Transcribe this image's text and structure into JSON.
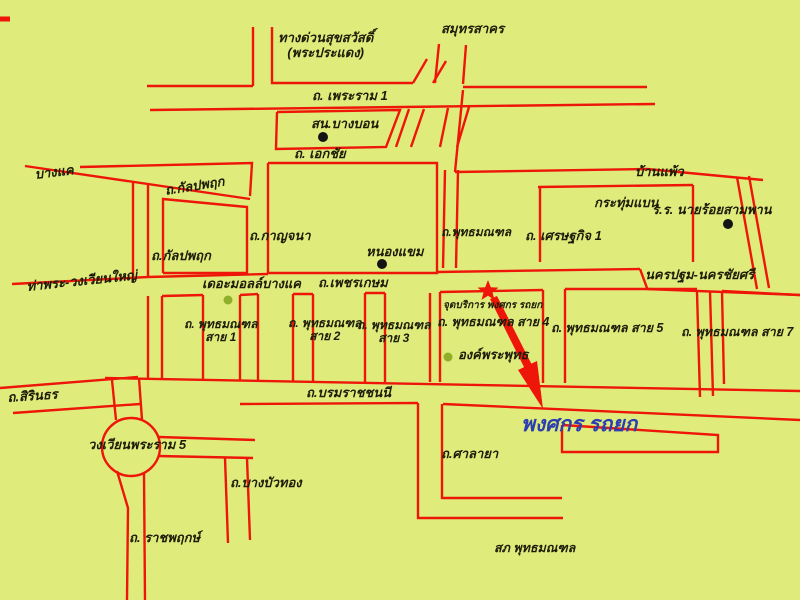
{
  "map": {
    "width": 800,
    "height": 600,
    "colors": {
      "background": "#dfec7c",
      "road": "#ee1509",
      "text": "#1c1c08",
      "highlight_blue": "#2a3eb1",
      "dot_black": "#141414",
      "dot_green": "#8fae29"
    },
    "labels": [
      {
        "id": "expressway-suksawat",
        "text": "ทางด่วนสุขสวัสดิ์\n(พระประแดง)",
        "x": 278,
        "y": 31,
        "size": 13
      },
      {
        "id": "samut-sakhon",
        "text": "สมุทรสาคร",
        "x": 441,
        "y": 22,
        "size": 13
      },
      {
        "id": "rama1-road",
        "text": "ถ. เพระราม 1",
        "x": 312,
        "y": 89,
        "size": 13
      },
      {
        "id": "bang-bon-police",
        "text": "สน.บางบอน",
        "x": 311,
        "y": 117,
        "size": 13
      },
      {
        "id": "ekkachai-road",
        "text": "ถ. เอกชัย",
        "x": 294,
        "y": 147,
        "size": 13
      },
      {
        "id": "bang-khae",
        "text": "บางแค",
        "x": 34,
        "y": 168,
        "size": 13,
        "rot": -7
      },
      {
        "id": "kanlapaphruek-road-upper",
        "text": "ถ.กัลปพฤก",
        "x": 164,
        "y": 184,
        "size": 13,
        "rot": -9
      },
      {
        "id": "kanlapaphruek-road-lower",
        "text": "ถ.กัลปพฤก",
        "x": 151,
        "y": 249,
        "size": 13
      },
      {
        "id": "kanchana-road",
        "text": "ถ.กาญจนา",
        "x": 249,
        "y": 229,
        "size": 13
      },
      {
        "id": "nong-khaem",
        "text": "หนองแขม",
        "x": 366,
        "y": 245,
        "size": 13
      },
      {
        "id": "phutthamonthon-road",
        "text": "ถ.พุทธมณฑล",
        "x": 441,
        "y": 226,
        "size": 12
      },
      {
        "id": "setthakit1-road",
        "text": "ถ. เศรษฐกิจ 1",
        "x": 525,
        "y": 229,
        "size": 13
      },
      {
        "id": "ban-phaeo",
        "text": "บ้านแพ้ว",
        "x": 635,
        "y": 165,
        "size": 13
      },
      {
        "id": "krathum-baen",
        "text": "กระทุ่มแบน",
        "x": 594,
        "y": 196,
        "size": 13
      },
      {
        "id": "military-academy",
        "text": "ร.ร. นายร้อยสามพาน",
        "x": 652,
        "y": 203,
        "size": 13
      },
      {
        "id": "tha-phra-wongwian-yai",
        "text": "ท่าพระ-วงเวียนใหญ่",
        "x": 26,
        "y": 280,
        "size": 13,
        "rot": -6
      },
      {
        "id": "the-mall-bang-khae",
        "text": "เดอะมอลล์บางแค",
        "x": 202,
        "y": 277,
        "size": 13
      },
      {
        "id": "phetkasem-road",
        "text": "ถ.เพชรเกษม",
        "x": 318,
        "y": 276,
        "size": 13
      },
      {
        "id": "nakhon-pathom-nakhon-chaisi",
        "text": "นครปฐม-นครชัยศรี",
        "x": 645,
        "y": 268,
        "size": 13
      },
      {
        "id": "service-point",
        "text": "จุดบริการ พงศกร รถยก",
        "x": 443,
        "y": 300,
        "size": 10
      },
      {
        "id": "phutthamonthon-sai1",
        "text": "ถ. พุทธมณฑล\nสาย 1",
        "x": 184,
        "y": 318,
        "size": 12
      },
      {
        "id": "phutthamonthon-sai2",
        "text": "ถ. พุทธมณฑล\nสาย 2",
        "x": 288,
        "y": 317,
        "size": 12
      },
      {
        "id": "phutthamonthon-sai3",
        "text": "ถ. พุทธมณฑล\nสาย 3",
        "x": 357,
        "y": 319,
        "size": 12
      },
      {
        "id": "phutthamonthon-sai4",
        "text": "ถ. พุทธมณฑล สาย 4",
        "x": 437,
        "y": 315,
        "size": 12.5
      },
      {
        "id": "phutthamonthon-sai5",
        "text": "ถ. พุทธมณฑล สาย 5",
        "x": 551,
        "y": 321,
        "size": 12.5
      },
      {
        "id": "phutthamonthon-sai7",
        "text": "ถ. พุทธมณฑล สาย 7",
        "x": 681,
        "y": 325,
        "size": 12.5
      },
      {
        "id": "buddha-monument",
        "text": "องค์พระพุทธ",
        "x": 458,
        "y": 348,
        "size": 13
      },
      {
        "id": "sirinthon-road",
        "text": "ถ.สิรินธร",
        "x": 7,
        "y": 391,
        "size": 13,
        "rot": -4
      },
      {
        "id": "borommaratchachonnani-road",
        "text": "ถ.บรมราชชนนี",
        "x": 306,
        "y": 386,
        "size": 13
      },
      {
        "id": "pongsakorn-towing",
        "text": "พงศกร รถยก",
        "x": 521,
        "y": 413,
        "size": 21,
        "color": "#2a3eb1"
      },
      {
        "id": "wongwian-rama5",
        "text": "วงเวียนพระราม 5",
        "x": 88,
        "y": 438,
        "size": 13
      },
      {
        "id": "salaya-road",
        "text": "ถ.ศาลายา",
        "x": 441,
        "y": 447,
        "size": 13
      },
      {
        "id": "bang-bua-thong-road",
        "text": "ถ.บางบัวทอง",
        "x": 230,
        "y": 476,
        "size": 13
      },
      {
        "id": "ratchaphruek-road",
        "text": "ถ. ราชพฤกษ์",
        "x": 129,
        "y": 531,
        "size": 13
      },
      {
        "id": "phutthamonthon-police",
        "text": "สภ พุทธมณฑล",
        "x": 494,
        "y": 541,
        "size": 12.5
      }
    ],
    "roads": [
      {
        "p": [
          [
            0,
            19
          ],
          [
            10,
            19
          ]
        ],
        "w": 5
      },
      {
        "p": [
          [
            253,
            27
          ],
          [
            253,
            86
          ]
        ]
      },
      {
        "p": [
          [
            272,
            27
          ],
          [
            272,
            83
          ],
          [
            413,
            83
          ]
        ]
      },
      {
        "p": [
          [
            147,
            86
          ],
          [
            253,
            86
          ]
        ]
      },
      {
        "p": [
          [
            413,
            83
          ],
          [
            427,
            59
          ]
        ]
      },
      {
        "p": [
          [
            433,
            83
          ],
          [
            446,
            61
          ]
        ]
      },
      {
        "p": [
          [
            439,
            44
          ],
          [
            435,
            83
          ]
        ]
      },
      {
        "p": [
          [
            466,
            45
          ],
          [
            463,
            84
          ]
        ]
      },
      {
        "p": [
          [
            463,
            87
          ],
          [
            647,
            87
          ]
        ]
      },
      {
        "p": [
          [
            150,
            110
          ],
          [
            655,
            104
          ]
        ]
      },
      {
        "p": [
          [
            277,
            112
          ],
          [
            400,
            110
          ],
          [
            386,
            147
          ],
          [
            276,
            149
          ],
          [
            277,
            112
          ]
        ]
      },
      {
        "p": [
          [
            409,
            109
          ],
          [
            396,
            147
          ]
        ]
      },
      {
        "p": [
          [
            424,
            109
          ],
          [
            411,
            147
          ]
        ]
      },
      {
        "p": [
          [
            448,
            108
          ],
          [
            440,
            147
          ]
        ]
      },
      {
        "p": [
          [
            469,
            107
          ],
          [
            457,
            147
          ]
        ]
      },
      {
        "p": [
          [
            463,
            90
          ],
          [
            455,
            172
          ]
        ]
      },
      {
        "p": [
          [
            455,
            172
          ],
          [
            647,
            169
          ],
          [
            763,
            180
          ]
        ]
      },
      {
        "p": [
          [
            737,
            177
          ],
          [
            757,
            289
          ]
        ]
      },
      {
        "p": [
          [
            749,
            176
          ],
          [
            769,
            288
          ]
        ]
      },
      {
        "p": [
          [
            80,
            167
          ],
          [
            252,
            163
          ],
          [
            250,
            196
          ]
        ]
      },
      {
        "p": [
          [
            25,
            166
          ],
          [
            250,
            199
          ]
        ]
      },
      {
        "p": [
          [
            133,
            182
          ],
          [
            133,
            281
          ]
        ]
      },
      {
        "p": [
          [
            148,
            184
          ],
          [
            148,
            277
          ]
        ]
      },
      {
        "p": [
          [
            163,
            273
          ],
          [
            163,
            199
          ],
          [
            247,
            207
          ],
          [
            247,
            273
          ],
          [
            163,
            273
          ]
        ]
      },
      {
        "p": [
          [
            268,
            163
          ],
          [
            437,
            163
          ],
          [
            437,
            273
          ],
          [
            268,
            273
          ],
          [
            268,
            163
          ]
        ]
      },
      {
        "p": [
          [
            445,
            170
          ],
          [
            443,
            268
          ]
        ]
      },
      {
        "p": [
          [
            458,
            170
          ],
          [
            456,
            268
          ]
        ]
      },
      {
        "p": [
          [
            538,
            187
          ],
          [
            693,
            185
          ]
        ]
      },
      {
        "p": [
          [
            540,
            187
          ],
          [
            540,
            262
          ]
        ]
      },
      {
        "p": [
          [
            693,
            185
          ],
          [
            693,
            262
          ]
        ]
      },
      {
        "p": [
          [
            148,
            277
          ],
          [
            268,
            274
          ]
        ]
      },
      {
        "p": [
          [
            437,
            272
          ],
          [
            640,
            269
          ]
        ]
      },
      {
        "p": [
          [
            12,
            284
          ],
          [
            148,
            277
          ]
        ]
      },
      {
        "p": [
          [
            640,
            269
          ],
          [
            647,
            288
          ]
        ]
      },
      {
        "p": [
          [
            647,
            289
          ],
          [
            800,
            295
          ]
        ]
      },
      {
        "p": [
          [
            697,
            292
          ],
          [
            700,
            397
          ]
        ]
      },
      {
        "p": [
          [
            710,
            291
          ],
          [
            713,
            396
          ]
        ]
      },
      {
        "p": [
          [
            148,
            296
          ],
          [
            148,
            380
          ]
        ]
      },
      {
        "p": [
          [
            162,
            296
          ],
          [
            162,
            380
          ]
        ]
      },
      {
        "p": [
          [
            203,
            295
          ],
          [
            203,
            380
          ]
        ]
      },
      {
        "p": [
          [
            240,
            295
          ],
          [
            240,
            381
          ]
        ]
      },
      {
        "p": [
          [
            258,
            294
          ],
          [
            258,
            381
          ]
        ]
      },
      {
        "p": [
          [
            293,
            294
          ],
          [
            293,
            381
          ]
        ]
      },
      {
        "p": [
          [
            313,
            294
          ],
          [
            313,
            381
          ]
        ]
      },
      {
        "p": [
          [
            365,
            293
          ],
          [
            365,
            382
          ]
        ]
      },
      {
        "p": [
          [
            385,
            293
          ],
          [
            385,
            382
          ]
        ]
      },
      {
        "p": [
          [
            430,
            293
          ],
          [
            430,
            382
          ]
        ]
      },
      {
        "p": [
          [
            440,
            292
          ],
          [
            440,
            382
          ]
        ]
      },
      {
        "p": [
          [
            543,
            290
          ],
          [
            543,
            383
          ]
        ]
      },
      {
        "p": [
          [
            565,
            289
          ],
          [
            565,
            383
          ]
        ]
      },
      {
        "p": [
          [
            722,
            291
          ],
          [
            724,
            384
          ]
        ]
      },
      {
        "p": [
          [
            162,
            296
          ],
          [
            203,
            295
          ]
        ]
      },
      {
        "p": [
          [
            240,
            295
          ],
          [
            258,
            294
          ]
        ]
      },
      {
        "p": [
          [
            293,
            294
          ],
          [
            313,
            294
          ]
        ]
      },
      {
        "p": [
          [
            365,
            293
          ],
          [
            385,
            293
          ]
        ]
      },
      {
        "p": [
          [
            440,
            292
          ],
          [
            543,
            290
          ]
        ]
      },
      {
        "p": [
          [
            565,
            289
          ],
          [
            697,
            289
          ]
        ]
      },
      {
        "p": [
          [
            722,
            291
          ],
          [
            800,
            295
          ]
        ]
      },
      {
        "p": [
          [
            105,
            378
          ],
          [
            800,
            391
          ]
        ]
      },
      {
        "p": [
          [
            240,
            404
          ],
          [
            418,
            403
          ]
        ]
      },
      {
        "p": [
          [
            443,
            404
          ],
          [
            800,
            420
          ]
        ]
      },
      {
        "p": [
          [
            418,
            403
          ],
          [
            418,
            518
          ],
          [
            563,
            518
          ]
        ]
      },
      {
        "p": [
          [
            442,
            404
          ],
          [
            442,
            498
          ],
          [
            562,
            498
          ]
        ]
      },
      {
        "p": [
          [
            562,
            425
          ],
          [
            562,
            452
          ],
          [
            718,
            452
          ],
          [
            718,
            435
          ],
          [
            562,
            425
          ]
        ]
      },
      {
        "p": [
          [
            112,
            380
          ],
          [
            116,
            420
          ]
        ]
      },
      {
        "p": [
          [
            139,
            378
          ],
          [
            142,
            420
          ]
        ]
      },
      {
        "p": [
          [
            159,
            437
          ],
          [
            255,
            440
          ]
        ]
      },
      {
        "p": [
          [
            158,
            456
          ],
          [
            253,
            458
          ]
        ]
      },
      {
        "p": [
          [
            117,
            471
          ],
          [
            128,
            508
          ],
          [
            127,
            600
          ]
        ]
      },
      {
        "p": [
          [
            144,
            473
          ],
          [
            145,
            600
          ]
        ]
      },
      {
        "p": [
          [
            0,
            388
          ],
          [
            138,
            377
          ]
        ]
      },
      {
        "p": [
          [
            13,
            413
          ],
          [
            140,
            404
          ]
        ]
      },
      {
        "p": [
          [
            225,
            458
          ],
          [
            228,
            543
          ]
        ]
      },
      {
        "p": [
          [
            247,
            458
          ],
          [
            250,
            540
          ]
        ]
      }
    ],
    "roundabout": {
      "cx": 131,
      "cy": 447,
      "r": 29
    },
    "star_marker": {
      "cx": 488,
      "cy": 291,
      "outer": 11,
      "inner": 4.7
    },
    "arrow": {
      "shaft": [
        [
          490,
          299
        ],
        [
          497,
          296
        ],
        [
          533,
          367
        ],
        [
          526,
          371
        ]
      ],
      "head": [
        [
          518,
          370
        ],
        [
          537,
          361
        ],
        [
          543,
          409
        ]
      ]
    },
    "pois": [
      {
        "id": "poi-bang-bon-police-dot",
        "type": "black",
        "x": 323,
        "y": 137,
        "r": 5
      },
      {
        "id": "poi-nong-khaem-dot",
        "type": "black",
        "x": 382,
        "y": 264,
        "r": 5
      },
      {
        "id": "poi-military-academy-dot",
        "type": "black",
        "x": 728,
        "y": 224,
        "r": 5
      },
      {
        "id": "poi-the-mall-dot",
        "type": "green",
        "x": 228,
        "y": 300,
        "r": 4.5
      },
      {
        "id": "poi-buddha-monument-dot",
        "type": "green",
        "x": 448,
        "y": 357,
        "r": 4.5
      }
    ]
  }
}
